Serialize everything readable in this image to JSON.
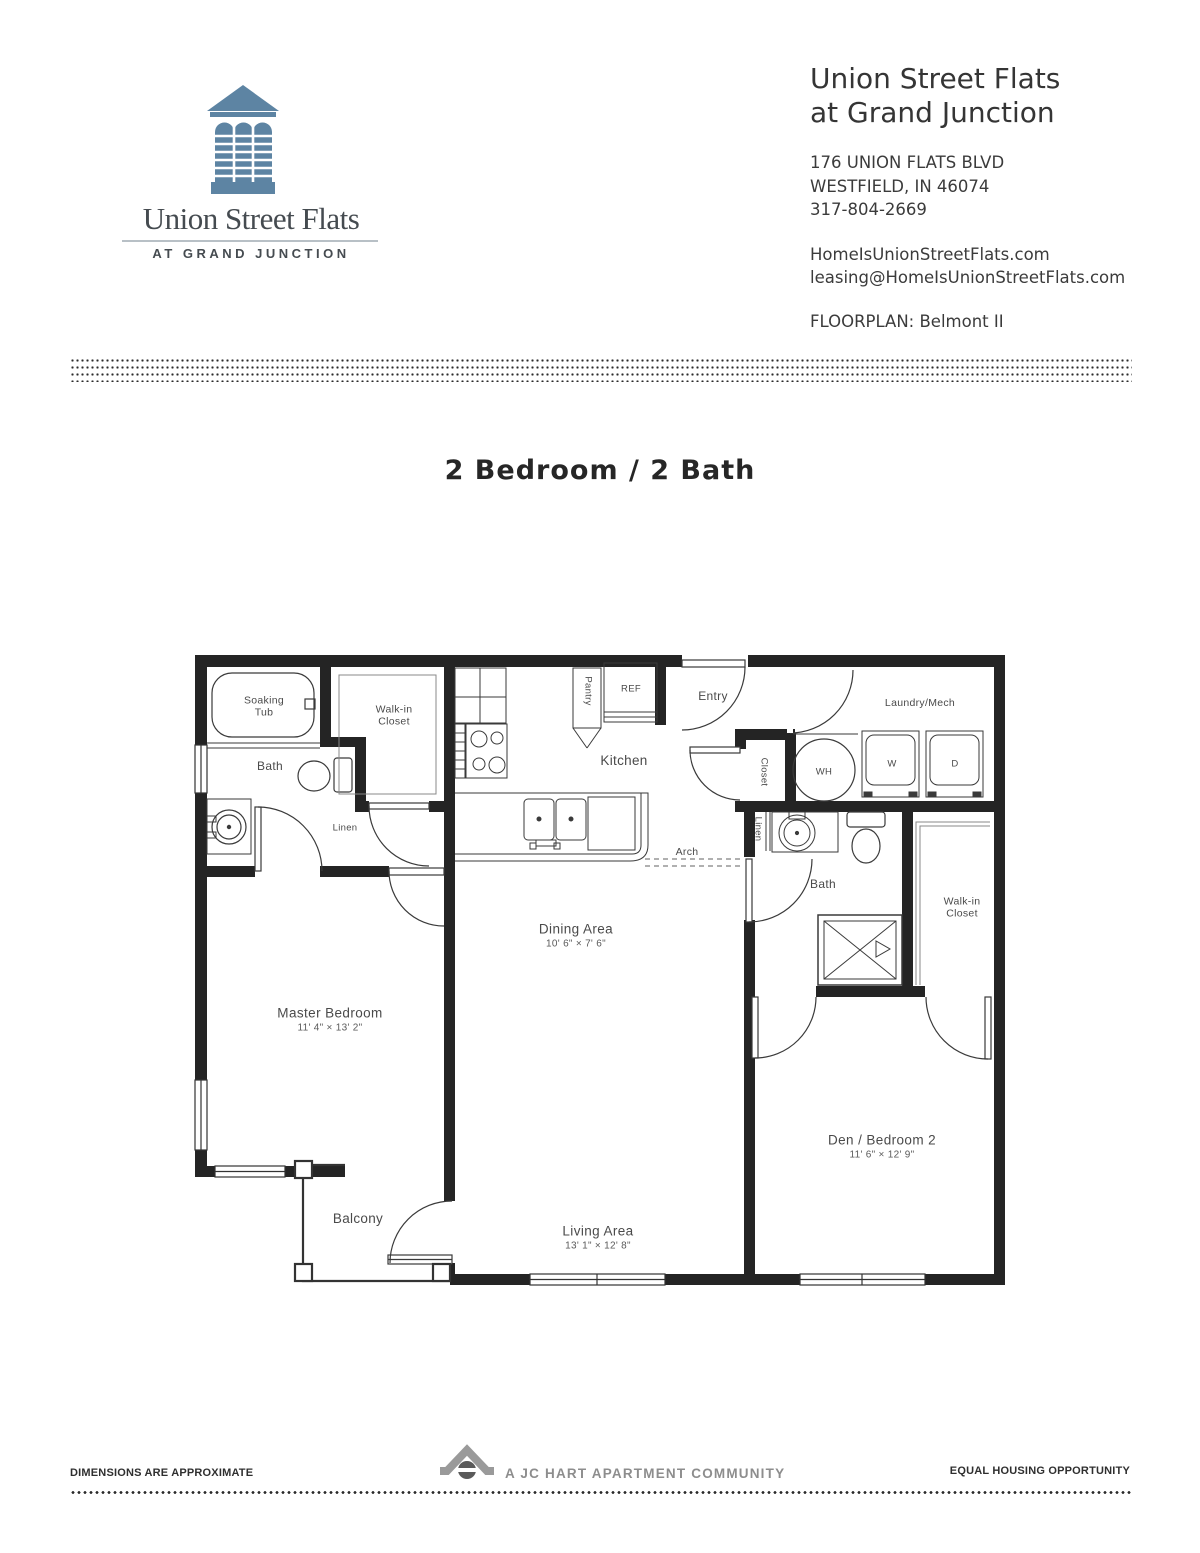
{
  "colors": {
    "logo_blue": "#5d84a3",
    "logo_text": "#454b50",
    "wall": "#242424",
    "footer_gray": "#8d8d8d"
  },
  "header": {
    "logo": {
      "icon": "cupola-icon",
      "wordmark": "Union Street Flats",
      "tagline": "AT GRAND JUNCTION"
    },
    "property_name_line1": "Union Street Flats",
    "property_name_line2": "at Grand Junction",
    "address_line1": "176 UNION FLATS BLVD",
    "address_line2": "WESTFIELD, IN 46074",
    "phone": "317-804-2669",
    "website": "HomeIsUnionStreetFlats.com",
    "email": "leasing@HomeIsUnionStreetFlats.com",
    "floorplan_label": "FLOORPLAN: Belmont II"
  },
  "title": "2 Bedroom / 2 Bath",
  "floorplan": {
    "name": "Belmont II",
    "labels": [
      {
        "name": "soaking-tub",
        "text": "Soaking\nTub",
        "x": 264,
        "y": 707,
        "cls": "small"
      },
      {
        "name": "bath-1",
        "text": "Bath",
        "x": 270,
        "y": 766,
        "cls": "med"
      },
      {
        "name": "walk-in-closet-1",
        "text": "Walk-in\nCloset",
        "x": 394,
        "y": 716,
        "cls": "small"
      },
      {
        "name": "linen-1",
        "text": "Linen",
        "x": 345,
        "y": 828,
        "cls": "xs"
      },
      {
        "name": "pantry",
        "text": "Pantry",
        "x": 588,
        "y": 691,
        "rot": 90,
        "cls": "xs"
      },
      {
        "name": "refrigerator",
        "text": "REF",
        "x": 631,
        "y": 689,
        "cls": "xs"
      },
      {
        "name": "kitchen",
        "text": "Kitchen",
        "x": 624,
        "y": 761,
        "cls": "lg"
      },
      {
        "name": "entry",
        "text": "Entry",
        "x": 713,
        "y": 696,
        "cls": "med"
      },
      {
        "name": "closet",
        "text": "Closet",
        "x": 764,
        "y": 772,
        "rot": 90,
        "cls": "xs"
      },
      {
        "name": "water-heater",
        "text": "WH",
        "x": 824,
        "y": 772,
        "cls": "xs"
      },
      {
        "name": "laundry-mech",
        "text": "Laundry/Mech",
        "x": 920,
        "y": 703,
        "cls": "small"
      },
      {
        "name": "washer",
        "text": "W",
        "x": 892,
        "y": 764,
        "cls": "xs"
      },
      {
        "name": "dryer",
        "text": "D",
        "x": 955,
        "y": 764,
        "cls": "xs"
      },
      {
        "name": "linen-2",
        "text": "Linen",
        "x": 758,
        "y": 829,
        "rot": 90,
        "cls": "xs"
      },
      {
        "name": "bath-2",
        "text": "Bath",
        "x": 823,
        "y": 884,
        "cls": "med"
      },
      {
        "name": "walk-in-closet-2",
        "text": "Walk-in\nCloset",
        "x": 962,
        "y": 908,
        "cls": "small"
      },
      {
        "name": "arch",
        "text": "Arch",
        "x": 687,
        "y": 852,
        "cls": "small"
      },
      {
        "name": "dining-area",
        "text": "Dining Area",
        "dims": "10' 6\" × 7' 6\"",
        "x": 576,
        "y": 936,
        "cls": "room"
      },
      {
        "name": "master-bedroom",
        "text": "Master Bedroom",
        "dims": "11' 4\" × 13' 2\"",
        "x": 330,
        "y": 1020,
        "cls": "room"
      },
      {
        "name": "den-bedroom-2",
        "text": "Den / Bedroom 2",
        "dims": "11' 6\" × 12' 9\"",
        "x": 882,
        "y": 1147,
        "cls": "room"
      },
      {
        "name": "living-area",
        "text": "Living Area",
        "dims": "13' 1\" × 12' 8\"",
        "x": 598,
        "y": 1238,
        "cls": "room"
      },
      {
        "name": "balcony",
        "text": "Balcony",
        "x": 358,
        "y": 1219,
        "cls": "lg"
      }
    ]
  },
  "footer": {
    "left": "DIMENSIONS ARE APPROXIMATE",
    "center_icon": "jc-hart-house-icon",
    "center": "A JC HART APARTMENT COMMUNITY",
    "right": "EQUAL HOUSING OPPORTUNITY"
  }
}
